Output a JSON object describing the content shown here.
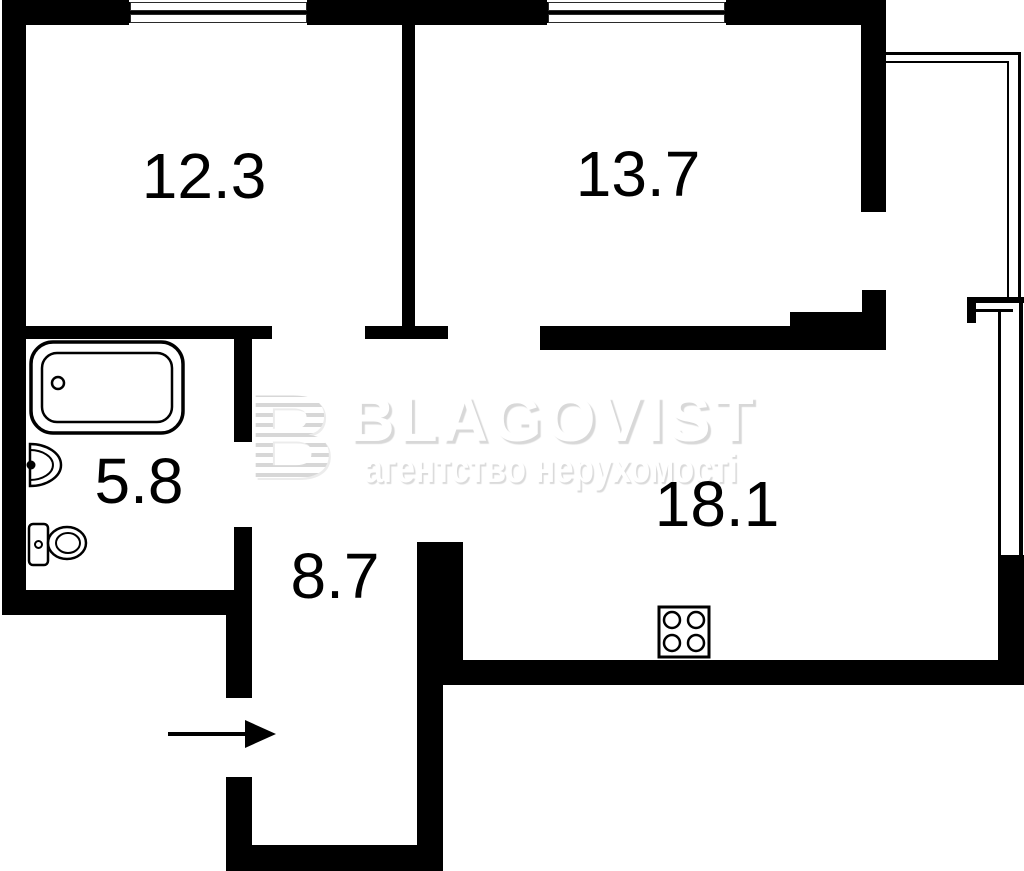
{
  "plan": {
    "background_color": "#ffffff",
    "wall_color": "#000000",
    "label_color": "#000000",
    "rooms": [
      {
        "id": "bedroom-1",
        "area": "12.3"
      },
      {
        "id": "bedroom-2",
        "area": "13.7"
      },
      {
        "id": "bathroom",
        "area": "5.8"
      },
      {
        "id": "hallway",
        "area": "8.7"
      },
      {
        "id": "living-kitchen",
        "area": "18.1"
      }
    ],
    "fixtures": [
      {
        "icon": "bathtub-icon"
      },
      {
        "icon": "sink-icon"
      },
      {
        "icon": "toilet-icon"
      },
      {
        "icon": "stove-icon"
      },
      {
        "icon": "entrance-arrow-icon"
      },
      {
        "icon": "window-icon"
      },
      {
        "icon": "balcony-glazing-icon"
      }
    ]
  },
  "watermark": {
    "logo_letter": "B",
    "brand": "BLAGOVIST",
    "tagline": "агентство нерухомості",
    "text_color": "#ffffff",
    "shadow_color": "#d8d8d8"
  }
}
